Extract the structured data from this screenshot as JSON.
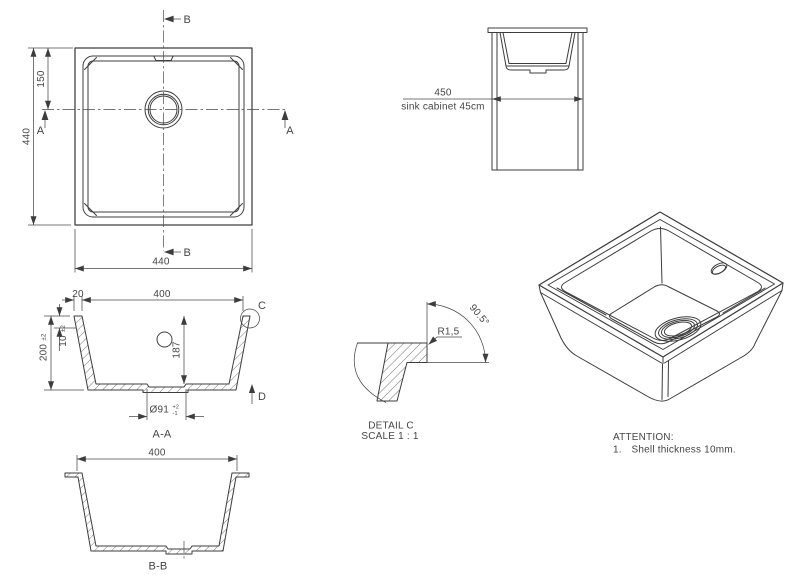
{
  "drawing": {
    "background": "#ffffff",
    "line_color": "#3d3d3d",
    "text_color": "#454545"
  },
  "top_view": {
    "section_b": "B",
    "section_a": "A",
    "dim_height": "440",
    "dim_width": "440",
    "dim_drain_from_top": "150"
  },
  "cabinet_view": {
    "dim_width": "450",
    "label": "sink cabinet 45cm"
  },
  "section_aa": {
    "title": "A-A",
    "dim_rim": "20",
    "dim_inner_width": "400",
    "dim_height": "200",
    "dim_height_tol": "±2",
    "dim_shell": "10",
    "dim_shell_tol": "±2",
    "dim_depth": "187",
    "dim_drain_dia": "Ø91",
    "dim_drain_tol_upper": "+2",
    "dim_drain_tol_lower": "-1",
    "detail_ref": "C",
    "direction_ref": "D"
  },
  "detail_c": {
    "title": "DETAIL C",
    "scale": "SCALE 1 : 1",
    "dim_radius": "R1,5",
    "dim_angle": "90.5°"
  },
  "section_bb": {
    "title": "B-B",
    "dim_inner_width": "400"
  },
  "attention": {
    "heading": "ATTENTION:",
    "note_number": "1.",
    "note_text": "Shell thickness 10mm."
  }
}
